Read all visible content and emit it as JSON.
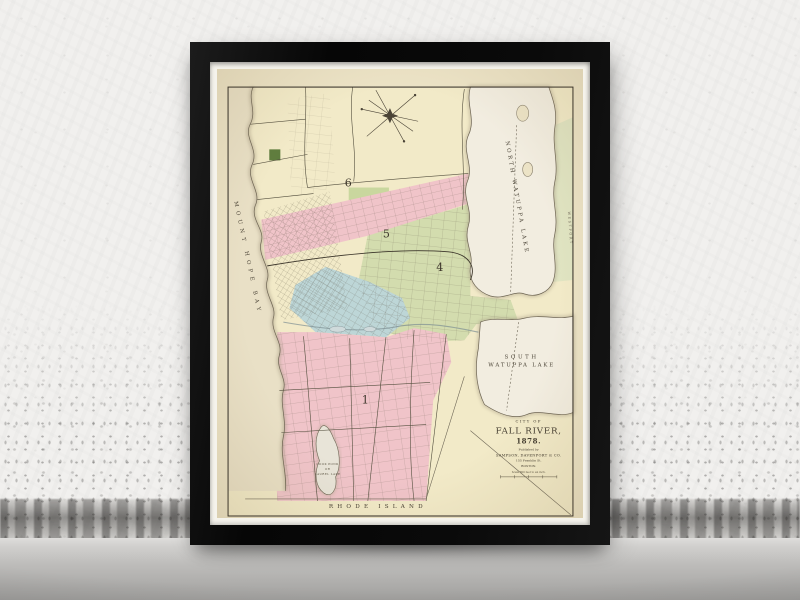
{
  "artwork": {
    "cartouche": {
      "kicker": "CITY OF",
      "title": "FALL RIVER,",
      "year": "1878.",
      "published_by": "Published by",
      "publisher": "SAMPSON, DAVENPORT & CO.",
      "address": "155 Franklin St.",
      "city": "BOSTON.",
      "scale_note": "Scale 800 feet to an inch."
    },
    "labels": {
      "north_lake": "NORTH WATUPPA LAKE",
      "south_lake_line1": "SOUTH",
      "south_lake_line2": "WATUPPA LAKE",
      "bay": "MOUNT HOPE BAY",
      "state_line": "RHODE ISLAND",
      "pond_line1": "COOK POND",
      "pond_line2": "OR",
      "pond_line3": "LAUREL LAKE",
      "east_margin": "WESTPORT"
    },
    "districts": [
      {
        "number": "6"
      },
      {
        "number": "5"
      },
      {
        "number": "4"
      },
      {
        "number": "1"
      }
    ],
    "colors": {
      "paper": "#ece3c6",
      "land_yellow": "#f2eac8",
      "ward_pink": "#f0c4c9",
      "ward_blue": "#bdd6d7",
      "ward_green": "#d3dcae",
      "water": "#f2ede0",
      "shore_shade": "#a89d85",
      "ink": "#413a2e",
      "frame": "#0b0b0b",
      "mat": "#f5f3ec",
      "wall": "#f1f0ee",
      "floor": "#b9b8b6"
    }
  }
}
